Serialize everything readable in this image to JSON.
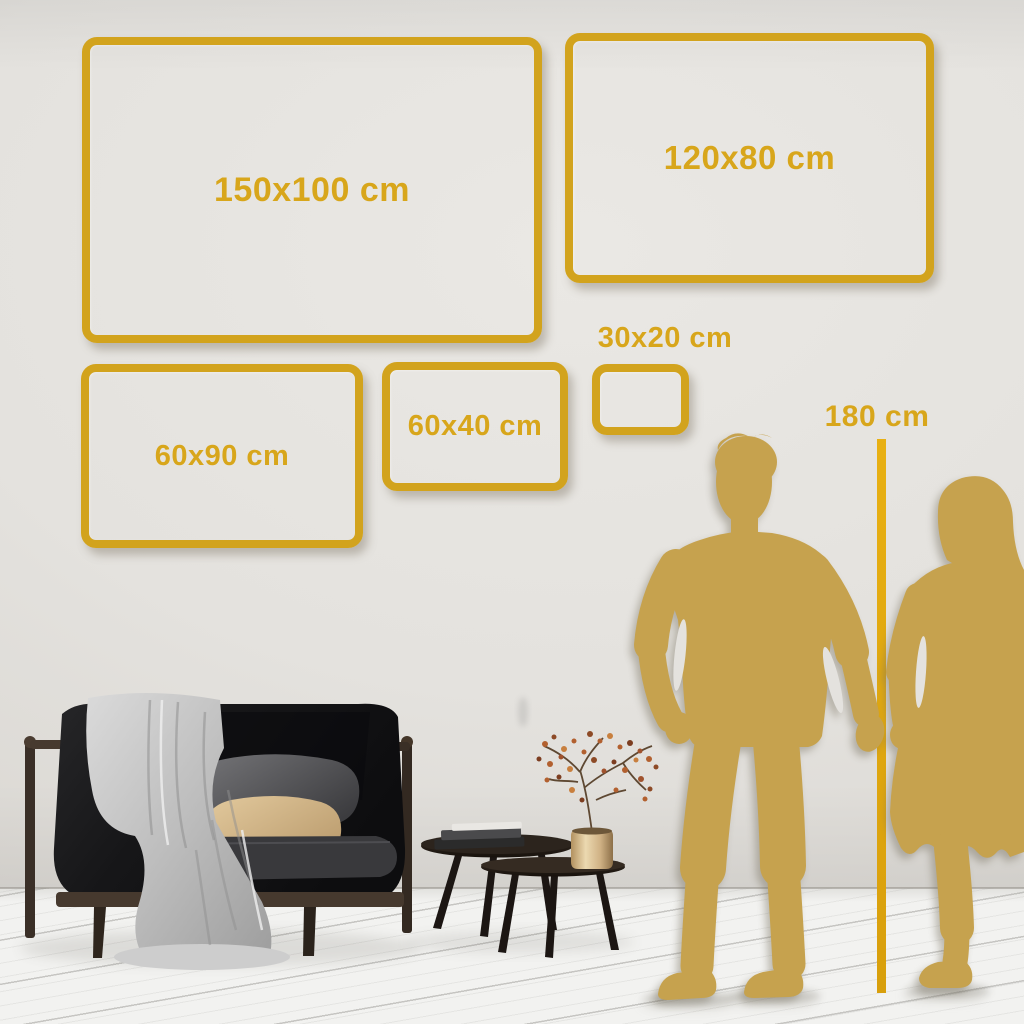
{
  "palette": {
    "gold_frame": "#D2A31D",
    "gold_text": "#D8A61B",
    "gold_line": "#E2A90F",
    "silhouette_gold": "#C6A24E",
    "wall": "#E4E2DE",
    "floor": "#F2F2F0"
  },
  "size_frames": [
    {
      "label": "150x100 cm",
      "width_cm": 150,
      "height_cm": 100
    },
    {
      "label": "120x80 cm",
      "width_cm": 120,
      "height_cm": 80
    },
    {
      "label": "60x90 cm",
      "width_cm": 60,
      "height_cm": 90
    },
    {
      "label": "60x40 cm",
      "width_cm": 60,
      "height_cm": 40
    },
    {
      "label": "30x20 cm",
      "width_cm": 30,
      "height_cm": 20
    }
  ],
  "height_reference": {
    "label": "180 cm",
    "value_cm": 180
  },
  "scene": {
    "figures": "couple-holding-hands-silhouette",
    "furniture": [
      "dark-sofa-with-blanket-and-pillows",
      "nesting-coffee-tables",
      "books",
      "brass-vase-with-dried-branch"
    ]
  }
}
